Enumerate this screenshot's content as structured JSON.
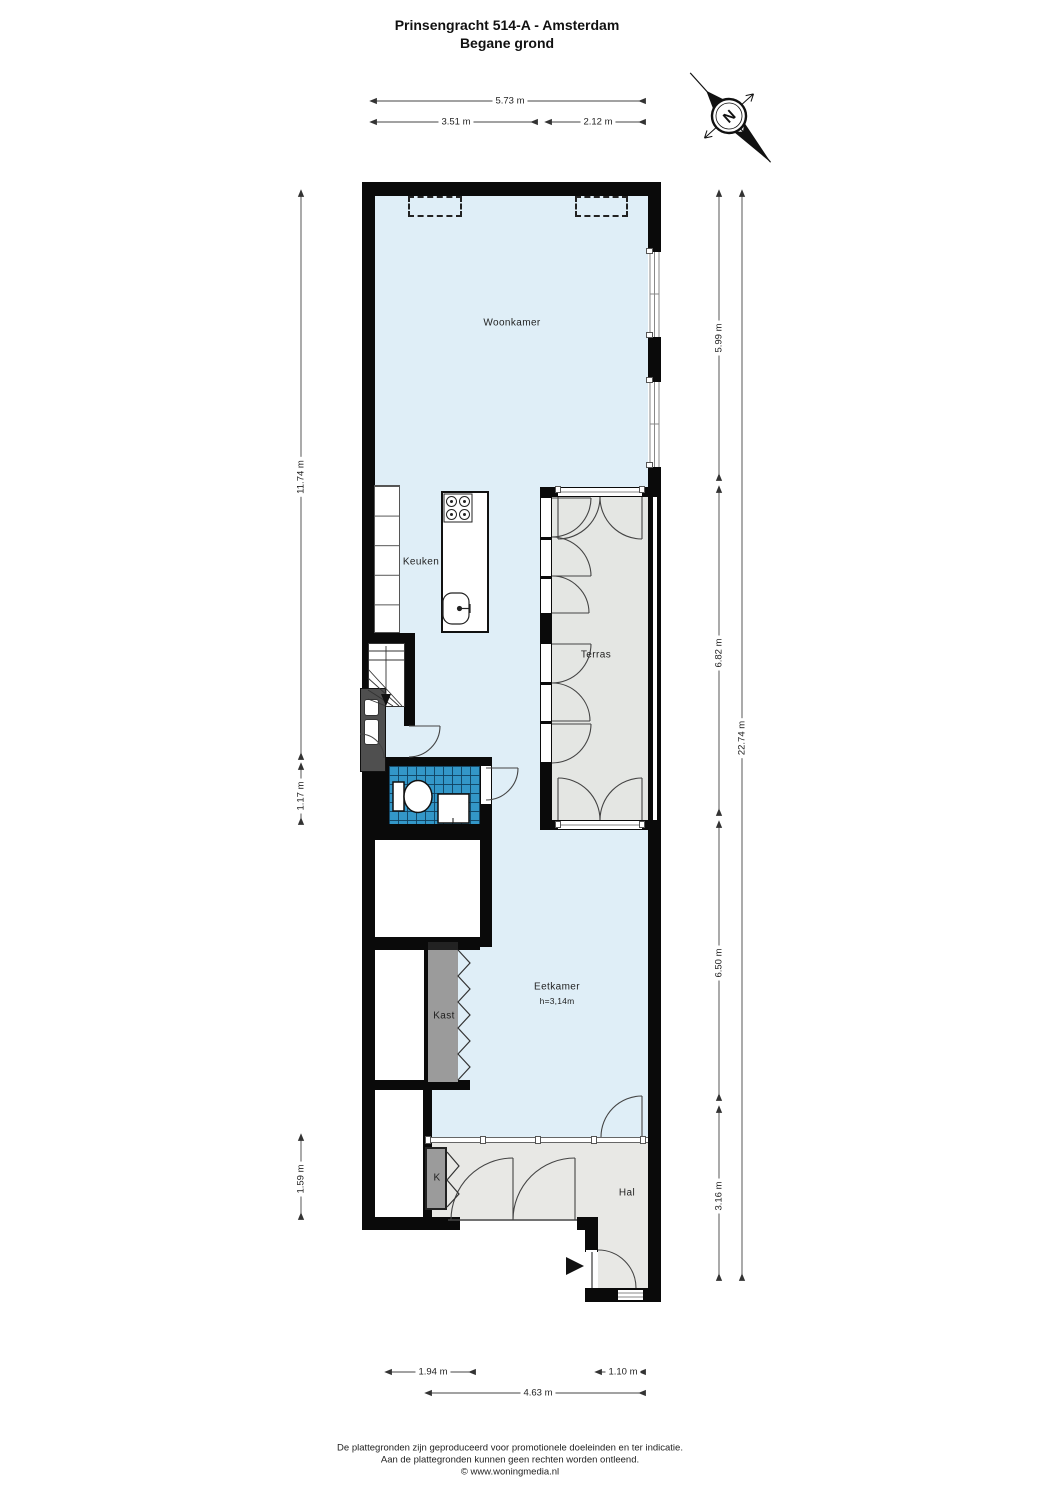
{
  "title": {
    "line1": "Prinsengracht 514-A - Amsterdam",
    "line2": "Begane grond"
  },
  "compass": {
    "north_label": "N"
  },
  "rooms": {
    "woonkamer": {
      "label": "Woonkamer"
    },
    "keuken": {
      "label": "Keuken"
    },
    "terras": {
      "label": "Terras"
    },
    "kast": {
      "label": "Kast"
    },
    "eetkamer": {
      "label": "Eetkamer",
      "height_note": "h=3,14m"
    },
    "k": {
      "label": "K"
    },
    "hal": {
      "label": "Hal"
    }
  },
  "dimensions": {
    "top": [
      {
        "value": "5.73 m"
      },
      {
        "value": "3.51 m"
      },
      {
        "value": "2.12 m"
      }
    ],
    "left": [
      {
        "value": "11.74 m"
      },
      {
        "value": "1.17 m"
      },
      {
        "value": "1.59 m"
      }
    ],
    "right": [
      {
        "value": "5.99 m"
      },
      {
        "value": "6.82 m"
      },
      {
        "value": "6.50 m"
      },
      {
        "value": "3.16 m"
      },
      {
        "value": "22.74 m"
      }
    ],
    "bottom": [
      {
        "value": "1.94 m"
      },
      {
        "value": "1.10 m"
      },
      {
        "value": "4.63 m"
      }
    ]
  },
  "footer": {
    "line1": "De plattegronden zijn geproduceerd voor promotionele doeleinden en ter indicatie.",
    "line2": "Aan de plattegronden kunnen geen rechten worden ontleend.",
    "line3": "© www.woningmedia.nl"
  },
  "colors": {
    "interior": "#dfeef7",
    "terrace": "#e4e6e3",
    "hall": "#e8e8e5",
    "closet": "#9b9b9b",
    "utility": "#4f4f4f",
    "tile_blue": "#3397c8",
    "wall": "#0a0a0a"
  }
}
